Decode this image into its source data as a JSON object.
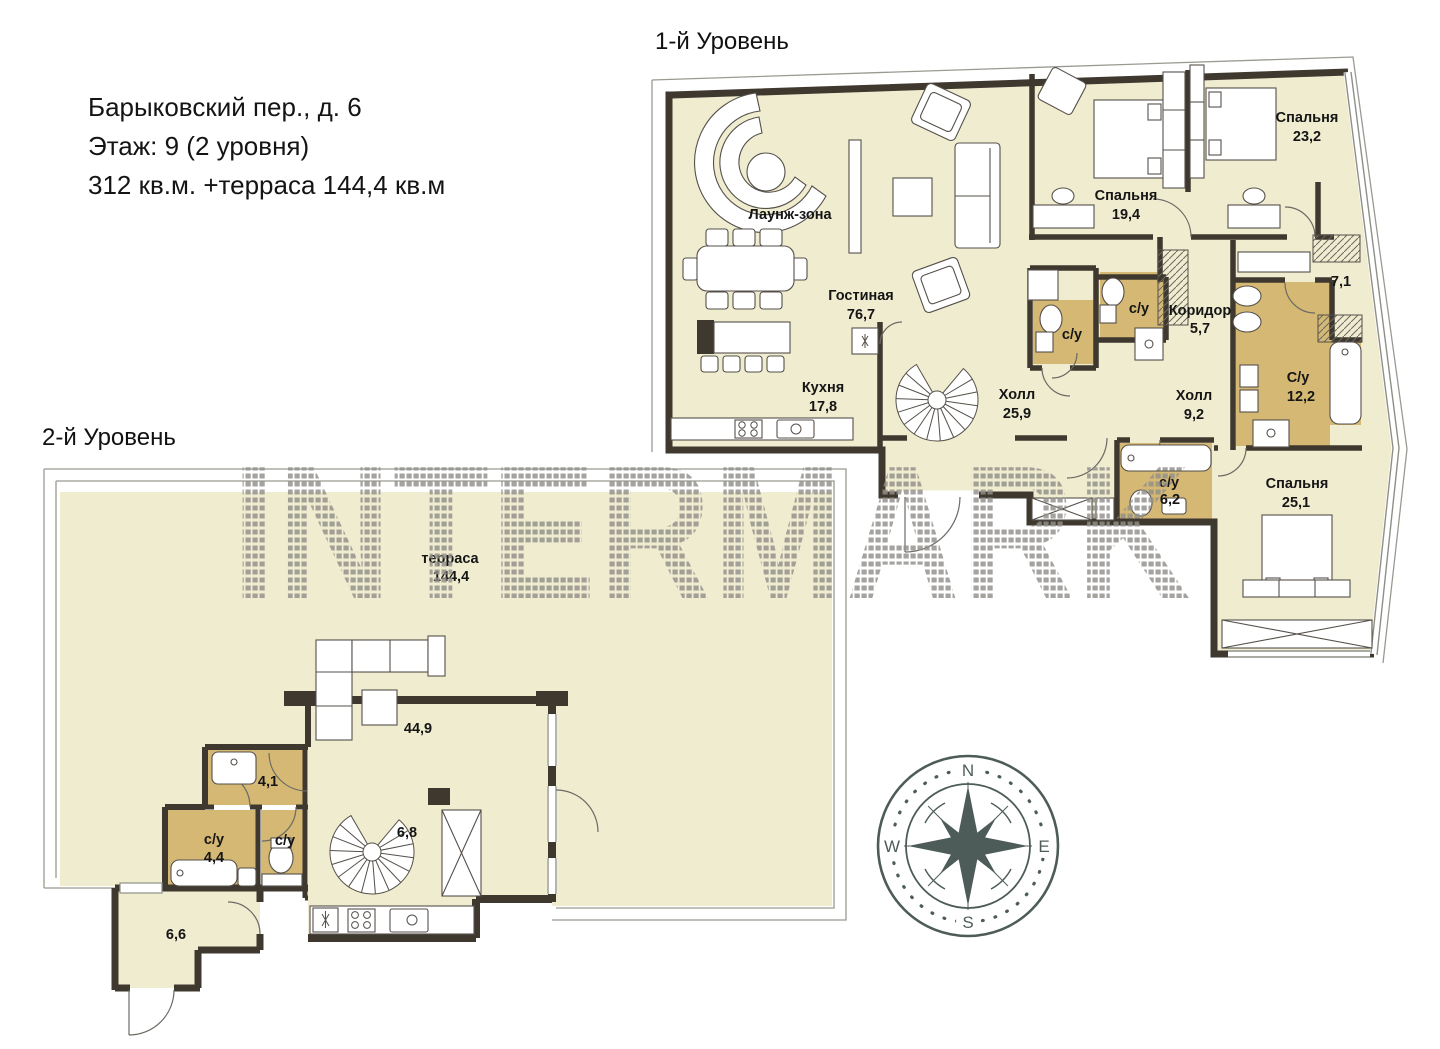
{
  "header": {
    "line1": "Барыковский пер., д. 6",
    "line2": "Этаж: 9 (2 уровня)",
    "line3": "312 кв.м. +терраса 144,4 кв.м"
  },
  "levels": {
    "level1": {
      "title": "1-й Уровень",
      "rooms": {
        "lounge": {
          "name": "Лаунж-зона",
          "area": ""
        },
        "living": {
          "name": "Гостиная",
          "area": "76,7"
        },
        "kitchen": {
          "name": "Кухня",
          "area": "17,8"
        },
        "hall_main": {
          "name": "Холл",
          "area": "25,9"
        },
        "bedroom1": {
          "name": "Спальня",
          "area": "19,4"
        },
        "bedroom2": {
          "name": "Спальня",
          "area": "23,2"
        },
        "wardrobe": {
          "name": "",
          "area": "7,1"
        },
        "bath_small1": {
          "name": "с/у",
          "area": ""
        },
        "bath_small2": {
          "name": "с/у",
          "area": ""
        },
        "corridor": {
          "name": "Коридор",
          "area": "5,7"
        },
        "hall_small": {
          "name": "Холл",
          "area": "9,2"
        },
        "bath_master": {
          "name": "С/у",
          "area": "12,2"
        },
        "bath_guest": {
          "name": "с/у",
          "area": "6,2"
        },
        "bedroom3": {
          "name": "Спальня",
          "area": "25,1"
        }
      }
    },
    "level2": {
      "title": "2-й Уровень",
      "rooms": {
        "terrace": {
          "name": "терраса",
          "area": "144,4"
        },
        "living2": {
          "name": "",
          "area": "44,9"
        },
        "hall2": {
          "name": "",
          "area": "4,1"
        },
        "bath2": {
          "name": "с/у",
          "area": "4,4"
        },
        "wc2": {
          "name": "с/у",
          "area": ""
        },
        "stairroom": {
          "name": "",
          "area": "6,8"
        },
        "entry": {
          "name": "",
          "area": "6,6"
        }
      }
    }
  },
  "watermark": {
    "text": "INTERMARK",
    "color": "#91908a"
  },
  "compass": {
    "n": "N",
    "e": "E",
    "s": "S",
    "w": "W",
    "color": "#4d5c59"
  },
  "colors": {
    "floor": "#f0ecd0",
    "wet": "#d4b873",
    "wall": "#3e382f",
    "thin": "#8f8f87"
  }
}
